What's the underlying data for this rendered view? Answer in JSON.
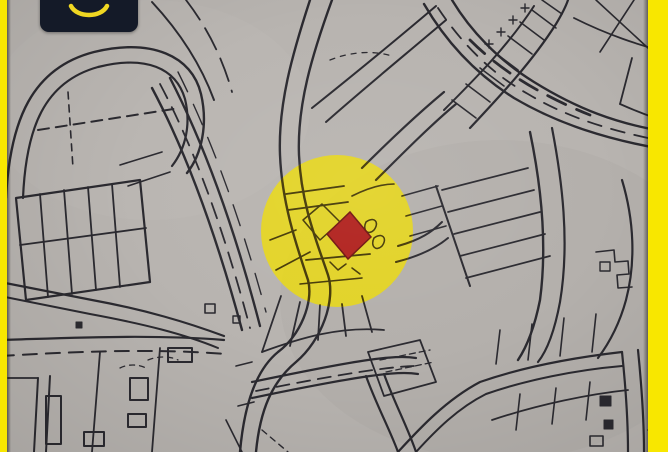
{
  "screen": {
    "kind": "scanned-cadastral-map-photo",
    "width_px": 668,
    "height_px": 452
  },
  "logo": {
    "text": "SAKANI",
    "icon": "smile-arc-icon",
    "background_color": "#141a28",
    "accent_color": "#f0d722"
  },
  "map": {
    "paper_color": "#b8b4b0",
    "ink_color": "#2b2a30",
    "highlight_ink_color": "#453908",
    "frame_stripe_color": "#f8e700",
    "highlight_circle": {
      "fill": "#eedc07",
      "opacity": "0.8",
      "center_x": "337",
      "center_y": "231",
      "radius": "76"
    },
    "selected_plot": {
      "fill": "#b1221e",
      "outline": "#701410"
    }
  }
}
